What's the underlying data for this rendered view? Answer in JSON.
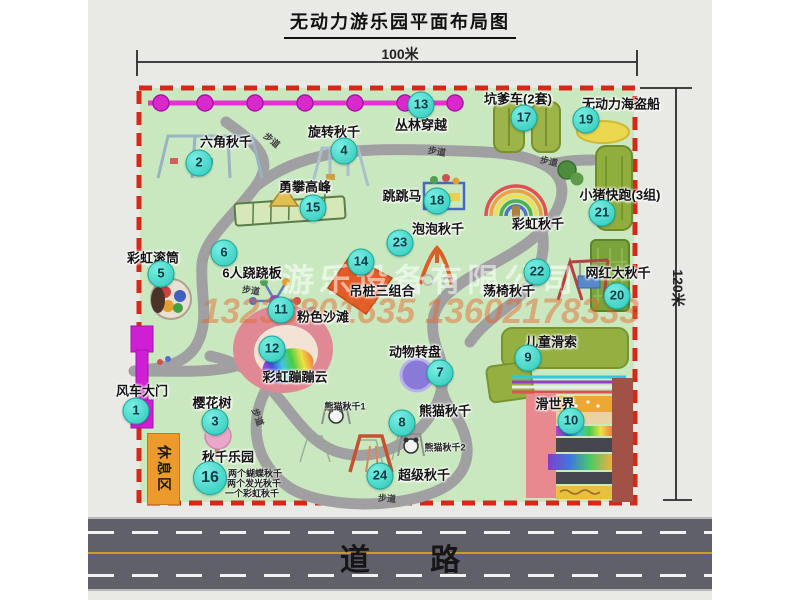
{
  "title": "无动力游乐园平面布局图",
  "dimension_top": "100米",
  "dimension_right": "120米",
  "road_label": "道 路",
  "rest_area_label": "休息区",
  "watermark": {
    "company": "游乐设备有限公司",
    "phone": "13233801635 13602178333"
  },
  "attractions": [
    {
      "num": "1",
      "label": "风车大门",
      "lx": 142,
      "ly": 390,
      "bx": 136,
      "by": 411
    },
    {
      "num": "2",
      "label": "六角秋千",
      "lx": 226,
      "ly": 141,
      "bx": 199,
      "by": 163
    },
    {
      "num": "3",
      "label": "樱花树",
      "lx": 212,
      "ly": 402,
      "bx": 215,
      "by": 422
    },
    {
      "num": "4",
      "label": "旋转秋千",
      "lx": 334,
      "ly": 131,
      "bx": 344,
      "by": 151
    },
    {
      "num": "5",
      "label": "彩虹滚筒",
      "lx": 153,
      "ly": 257,
      "bx": 161,
      "by": 274
    },
    {
      "num": "6",
      "label": "6人跷跷板",
      "lx": 252,
      "ly": 272,
      "bx": 224,
      "by": 253
    },
    {
      "num": "7",
      "label": "动物转盘",
      "lx": 415,
      "ly": 351,
      "bx": 440,
      "by": 373
    },
    {
      "num": "8",
      "label": "熊猫秋千",
      "lx": 445,
      "ly": 410,
      "bx": 402,
      "by": 423
    },
    {
      "num": "9",
      "label": "儿童滑索",
      "lx": 551,
      "ly": 341,
      "bx": 528,
      "by": 358
    },
    {
      "num": "10",
      "label": "滑世界",
      "lx": 555,
      "ly": 403,
      "bx": 571,
      "by": 421
    },
    {
      "num": "11",
      "label": "粉色沙滩",
      "lx": 323,
      "ly": 316,
      "bx": 281,
      "by": 310
    },
    {
      "num": "12",
      "label": "彩虹蹦蹦云",
      "lx": 295,
      "ly": 376,
      "bx": 272,
      "by": 349
    },
    {
      "num": "13",
      "label": "丛林穿越",
      "lx": 421,
      "ly": 124,
      "bx": 421,
      "by": 105
    },
    {
      "num": "14",
      "label": "吊桩三组合",
      "lx": 382,
      "ly": 290,
      "bx": 361,
      "by": 262
    },
    {
      "num": "15",
      "label": "勇攀高峰",
      "lx": 305,
      "ly": 186,
      "bx": 313,
      "by": 208
    },
    {
      "num": "16",
      "label": "秋千乐园",
      "lx": 228,
      "ly": 456,
      "bx": 210,
      "by": 478,
      "bs": 32
    },
    {
      "num": "17",
      "label": "坑爹车(2套)",
      "lx": 518,
      "ly": 98,
      "bx": 524,
      "by": 118
    },
    {
      "num": "18",
      "label": "跳跳马",
      "lx": 402,
      "ly": 195,
      "bx": 437,
      "by": 201
    },
    {
      "num": "19",
      "label": "无动力海盗船",
      "lx": 621,
      "ly": 103,
      "bx": 586,
      "by": 120
    },
    {
      "num": "20",
      "label": "网红大秋千",
      "lx": 618,
      "ly": 272,
      "bx": 617,
      "by": 296
    },
    {
      "num": "21",
      "label": "小猪快跑(3组)",
      "lx": 620,
      "ly": 194,
      "bx": 602,
      "by": 213
    },
    {
      "num": "22",
      "label": "荡椅秋千",
      "lx": 509,
      "ly": 290,
      "bx": 537,
      "by": 272
    },
    {
      "num": "23",
      "label": "泡泡秋千",
      "lx": 438,
      "ly": 228,
      "bx": 400,
      "by": 243
    },
    {
      "num": "24",
      "label": "超级秋千",
      "lx": 424,
      "ly": 474,
      "bx": 380,
      "by": 476
    },
    {
      "num": "",
      "label": "彩虹秋千",
      "lx": 538,
      "ly": 223
    }
  ],
  "sub_labels": [
    {
      "text": "熊猫秋千1",
      "x": 345,
      "y": 406
    },
    {
      "text": "熊猫秋千2",
      "x": 445,
      "y": 447
    },
    {
      "text": "两个蝴蝶秋千",
      "x": 255,
      "y": 473
    },
    {
      "text": "两个发光秋千",
      "x": 254,
      "y": 483
    },
    {
      "text": "一个彩虹秋千",
      "x": 252,
      "y": 493
    }
  ],
  "path_labels": [
    {
      "text": "步道",
      "x": 272,
      "y": 140,
      "rot": 40
    },
    {
      "text": "步道",
      "x": 437,
      "y": 151,
      "rot": 10
    },
    {
      "text": "步道",
      "x": 549,
      "y": 161,
      "rot": 12
    },
    {
      "text": "步道",
      "x": 251,
      "y": 290,
      "rot": 8
    },
    {
      "text": "步道",
      "x": 258,
      "y": 417,
      "rot": 70
    },
    {
      "text": "步道",
      "x": 387,
      "y": 498,
      "rot": 4
    }
  ]
}
